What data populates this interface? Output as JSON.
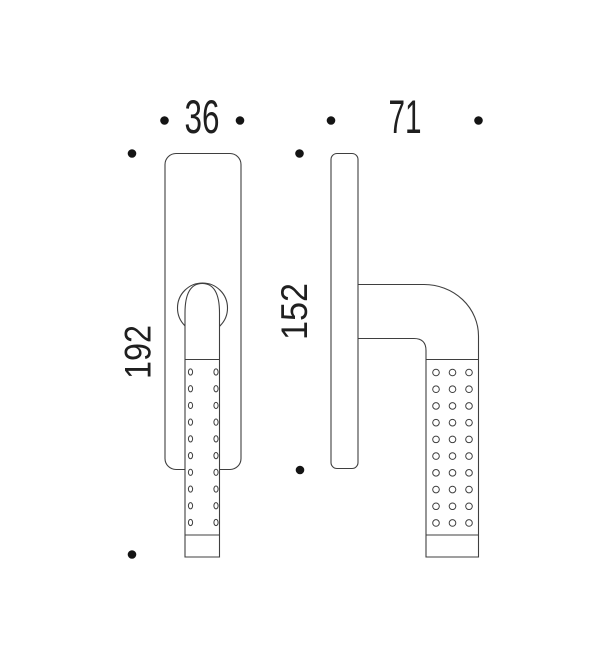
{
  "drawing": {
    "title": "window-handle-technical-drawing",
    "background_color": "#ffffff",
    "line_color": "#3f3f3f",
    "ink_color": "#1f1f1f",
    "marker_color": "#141414"
  },
  "dimensions": {
    "front_width_mm": "36",
    "side_depth_mm": "71",
    "front_height_mm": "192",
    "plate_height_mm": "152"
  },
  "knurl": {
    "front": {
      "columns": [
        190.5,
        216.0
      ],
      "rows": 10,
      "first_row_y": 372.0,
      "row_spacing": 16.72,
      "dot_rx": 2.1,
      "dot_ry": 3.1
    },
    "side": {
      "columns": [
        436.0,
        452.5,
        469.0
      ],
      "rows": 10,
      "first_row_y": 372.5,
      "row_spacing": 16.72,
      "dot_rx": 3.3,
      "dot_ry": 3.3
    }
  },
  "markers": {
    "points": [
      {
        "x": 164.5,
        "y": 120.5
      },
      {
        "x": 240.0,
        "y": 120.5
      },
      {
        "x": 331.0,
        "y": 120.5
      },
      {
        "x": 478.5,
        "y": 120.5
      },
      {
        "x": 132.0,
        "y": 153.5
      },
      {
        "x": 132.0,
        "y": 554.5
      },
      {
        "x": 299.5,
        "y": 153.5
      },
      {
        "x": 300.0,
        "y": 470.0
      }
    ],
    "radius": 4.3
  }
}
